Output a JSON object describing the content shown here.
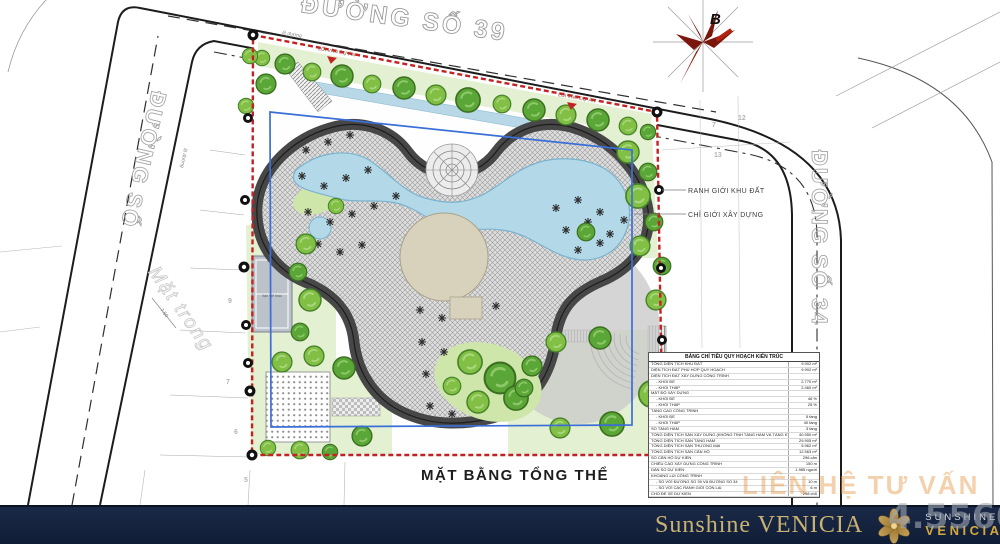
{
  "plan": {
    "title": "MẶT BẰNG TỔNG THỂ",
    "roads": {
      "top": "ĐƯỜNG SỐ 39",
      "right": "ĐƯỜNG SỐ 34",
      "left": "ĐƯỜNG SỐ"
    },
    "compass": {
      "north": "B"
    },
    "labels": {
      "boundary": "RANH GIỚI KHU ĐẤT",
      "construction": "CHỈ GIỚI XÂY DỰNG",
      "entrance1": "LỐI VÀO DỰ ÁN",
      "entrance2": "LỐI VÀO DỰ ÁN",
      "curb1": "lề đường",
      "curb2": "lề đường",
      "court": "Sân thể thao",
      "dimension": "7.50",
      "parcel_text": "Mặt trong"
    },
    "parcel_numbers": [
      "9",
      "7",
      "6",
      "5",
      "7",
      "12",
      "13"
    ],
    "table": {
      "title": "BẢNG CHỈ TIÊU QUY HOẠCH KIẾN TRÚC",
      "rows": [
        {
          "label": "TỔNG DIỆN TÍCH KHU ĐẤT",
          "value": "9.902 m²",
          "indent": false
        },
        {
          "label": "DIỆN TÍCH ĐẤT PHÙ HỢP QUY HOẠCH",
          "value": "9.902 m²",
          "indent": false
        },
        {
          "label": "DIỆN TÍCH ĐẤT XÂY DỰNG CÔNG TRÌNH",
          "value": "",
          "indent": false
        },
        {
          "label": "- KHỐI ĐẾ",
          "value": "2.770 m²",
          "indent": true
        },
        {
          "label": "- KHỐI THÁP",
          "value": "2.460 m²",
          "indent": true
        },
        {
          "label": "MẬT ĐỘ XÂY DỰNG",
          "value": "",
          "indent": false
        },
        {
          "label": "- KHỐI ĐẾ",
          "value": "46 %",
          "indent": true
        },
        {
          "label": "- KHỐI THÁP",
          "value": "25 %",
          "indent": true
        },
        {
          "label": "TẦNG CAO CÔNG TRÌNH",
          "value": "",
          "indent": false
        },
        {
          "label": "- KHỐI ĐẾ",
          "value": "5 tầng",
          "indent": true
        },
        {
          "label": "- KHỐI THÁP",
          "value": "40 tầng",
          "indent": true
        },
        {
          "label": "SỐ TẦNG HẦM",
          "value": "3 tầng",
          "indent": false
        },
        {
          "label": "TỔNG DIỆN TÍCH SÀN XÂY DỰNG (KHÔNG TÍNH TẦNG HẦM VÀ TẦNG KỸ THUẬT)",
          "value": "40.950 m²",
          "indent": false
        },
        {
          "label": "TỔNG DIỆN TÍCH SÀN TẦNG HẦM",
          "value": "29.905 m²",
          "indent": false
        },
        {
          "label": "TỔNG DIỆN TÍCH SÀN THƯƠNG MẠI",
          "value": "5.962 m²",
          "indent": false
        },
        {
          "label": "TỔNG DIỆN TÍCH SÀN CĂN HỘ",
          "value": "12.563 m²",
          "indent": false
        },
        {
          "label": "SỐ CĂN HỘ DỰ KIẾN",
          "value": "296 căn",
          "indent": false
        },
        {
          "label": "CHIỀU CAO XÂY DỰNG CÔNG TRÌNH",
          "value": "150 m",
          "indent": false
        },
        {
          "label": "DÂN SỐ DỰ KIẾN",
          "value": "1.985 người",
          "indent": false
        },
        {
          "label": "KHOẢNG LÙI CÔNG TRÌNH",
          "value": "",
          "indent": false
        },
        {
          "label": "- SO VỚI ĐƯỜNG SỐ 39 VÀ ĐƯỜNG SỐ 34",
          "value": "10 m",
          "indent": true
        },
        {
          "label": "- SO VỚI CÁC RANH GIỚI CÒN LẠI",
          "value": "6 m",
          "indent": true
        },
        {
          "label": "CHỖ ĐỂ XE DỰ KIẾN",
          "value": "298 chỗ",
          "indent": false
        }
      ]
    }
  },
  "watermarks": {
    "contact": "LIÊN HỆ TƯ VẤN",
    "phone": "4.5566"
  },
  "footer": {
    "brand": "Sunshine VENICIA",
    "logo_line1": "SUNSHINE",
    "logo_line2": "VENICIA"
  },
  "colors": {
    "boundary_red": "#c32222",
    "construction_blue": "#3a6fd8",
    "banner_navy": "#14213d",
    "gold": "#c9a85c",
    "tree_green": "#82bf45",
    "pool_blue": "#b3d9e8"
  }
}
